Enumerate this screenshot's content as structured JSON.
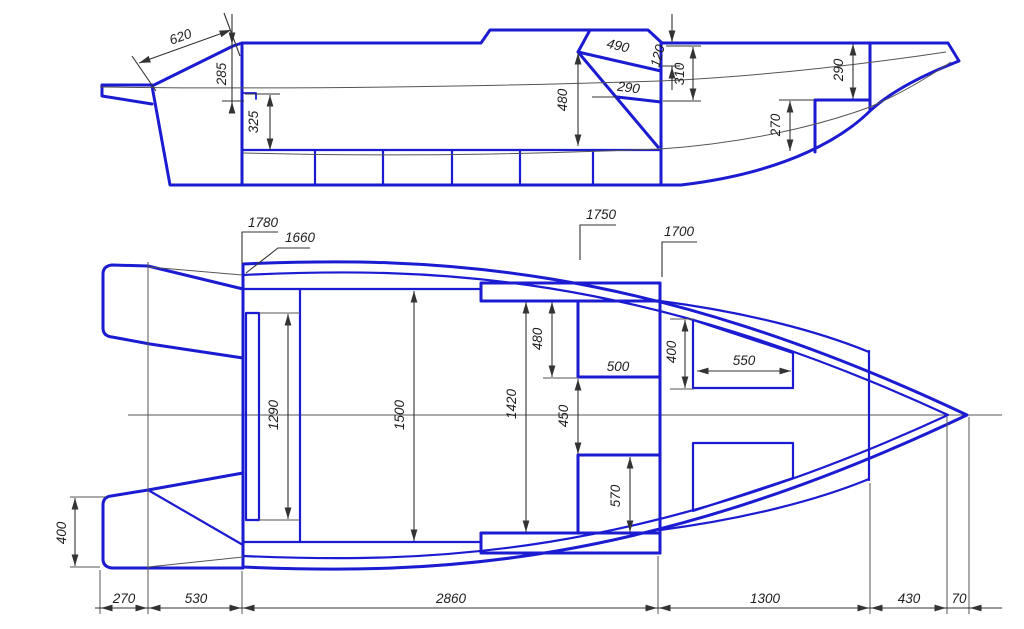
{
  "drawing": {
    "type": "technical drawing — boat hull, side view and plan view with dimensions",
    "units": "mm",
    "accent_color": "#1b1bd2",
    "dim_color": "#333333"
  },
  "side_view": {
    "dims": {
      "bracket_620": "620",
      "transom_285": "285",
      "depth_325": "325",
      "console_480": "480",
      "windshield_490": "490",
      "glass_290": "290",
      "coaming_120": "120",
      "dash_310": "310",
      "bow_290": "290",
      "step_270": "270"
    }
  },
  "plan_view": {
    "callouts": {
      "beam_1780": "1780",
      "beam_1660": "1660",
      "beam_1750": "1750",
      "beam_1700": "1700"
    },
    "dims": {
      "transom_1290": "1290",
      "cockpit_1500": "1500",
      "cockpit_1420": "1420",
      "console_480": "480",
      "console_500": "500",
      "gap_450": "450",
      "seat_570": "570",
      "bow_seat_400": "400",
      "bow_seat_550": "550",
      "platform_400": "400"
    }
  },
  "bottom_chain": {
    "d270": "270",
    "d530": "530",
    "d2860": "2860",
    "d1300": "1300",
    "d430": "430",
    "d70": "70"
  }
}
